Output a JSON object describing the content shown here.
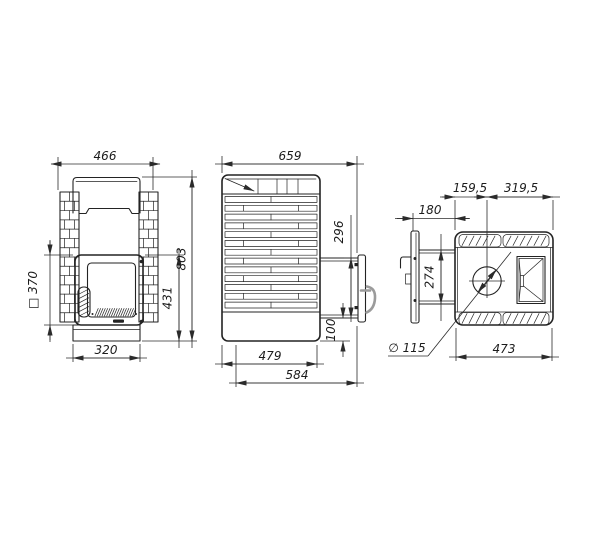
{
  "drawing": {
    "kind": "stove-three-view-technical-drawing",
    "line_color": "#232323",
    "handle_color": "#9b9b9b"
  },
  "views": {
    "front": {
      "dims": {
        "width": "466",
        "door": "□ 370",
        "firebox_height": "431",
        "height": "803",
        "base_width": "320"
      }
    },
    "side": {
      "dims": {
        "depth_total": "659",
        "door_frame_height": "296",
        "bottom_offset": "100",
        "body_depth": "479",
        "depth_with_door": "584"
      }
    },
    "top": {
      "dims": {
        "front_to_chimney": "159,5",
        "chimney_to_back": "319,5",
        "tunnel_length": "180",
        "tunnel_width": "274",
        "chimney_diameter": "∅ 115",
        "width": "473"
      }
    }
  }
}
